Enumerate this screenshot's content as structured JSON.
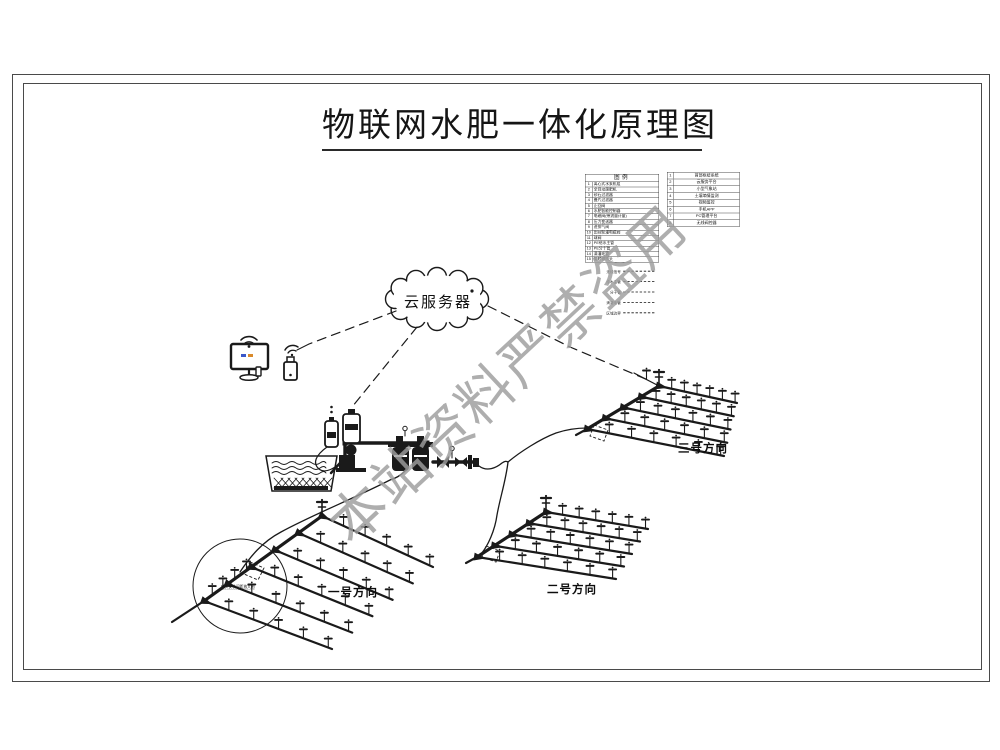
{
  "page": {
    "title": "物联网水肥一体化原理图"
  },
  "watermark": {
    "text": "本站资料严禁盗用",
    "color": "#9d9d9d"
  },
  "cloud": {
    "label": "云服务器"
  },
  "fields": [
    {
      "label": "一号方向"
    },
    {
      "label": "二号方向"
    },
    {
      "label": "三号方向"
    }
  ],
  "legend": {
    "title": "图例",
    "left_rows": [
      [
        "1",
        "离心式水泵机组"
      ],
      [
        "2",
        "全自动施肥机"
      ],
      [
        "3",
        "砂石过滤器"
      ],
      [
        "4",
        "叠片过滤器"
      ],
      [
        "5",
        "止回阀"
      ],
      [
        "6",
        "水肥智能控制器"
      ],
      [
        "7",
        "电磁阀(带流量计量)"
      ],
      [
        "8",
        "压力变送器"
      ],
      [
        "9",
        "进排气阀"
      ],
      [
        "10",
        "田间轮灌电磁阀"
      ],
      [
        "11",
        "球阀"
      ],
      [
        "12",
        "PE给水主管"
      ],
      [
        "13",
        "PE分干管"
      ],
      [
        "14",
        "滴灌毛管"
      ],
      [
        "15",
        "旋转微喷头"
      ]
    ],
    "right_rows": [
      [
        "1",
        "首部枢纽系统"
      ],
      [
        "2",
        "云服务平台"
      ],
      [
        "3",
        "小型气象站"
      ],
      [
        "4",
        "土壤墒情监测"
      ],
      [
        "5",
        "视频监控"
      ],
      [
        "6",
        "手机APP"
      ],
      [
        "7",
        "PC管理平台"
      ],
      [
        "8",
        "无线阀控器"
      ]
    ],
    "line_samples": [
      "无线信号",
      "给水主管",
      "分干管",
      "滴灌毛管",
      "区域边界"
    ]
  },
  "detail": {
    "note": "喷头安装间距放大图"
  },
  "colors": {
    "line": "#1a1a1a",
    "frame": "#4a4a4a",
    "watermark": "#9d9d9d",
    "screen_blue": "#3a57c9",
    "screen_orange": "#d98a2b"
  }
}
